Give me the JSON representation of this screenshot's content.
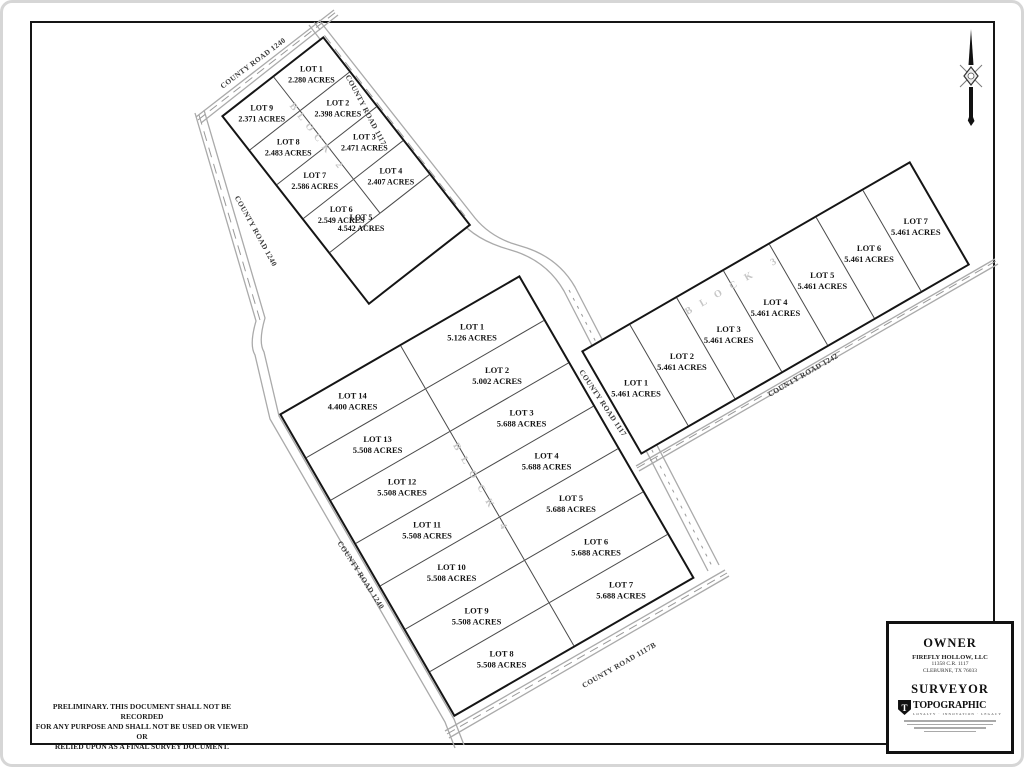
{
  "plat": {
    "preliminary_note_lines": [
      "PRELIMINARY. THIS DOCUMENT SHALL NOT BE RECORDED",
      "FOR ANY PURPOSE AND SHALL NOT BE USED OR VIEWED OR",
      "RELIED UPON AS A FINAL SURVEY DOCUMENT."
    ]
  },
  "roads": {
    "cr1240": "COUNTY ROAD 1240",
    "cr1117": "COUNTY ROAD 1117",
    "cr1117b": "COUNTY ROAD 1117B",
    "cr1242": "COUNTY ROAD 1242"
  },
  "blocks": {
    "block2": {
      "label": "BLOCK 2",
      "left_column": [
        {
          "lot": "LOT 9",
          "acres": "2.371 ACRES"
        },
        {
          "lot": "LOT 8",
          "acres": "2.483 ACRES"
        },
        {
          "lot": "LOT 7",
          "acres": "2.586 ACRES"
        },
        {
          "lot": "LOT 6",
          "acres": "2.549 ACRES"
        }
      ],
      "right_column": [
        {
          "lot": "LOT 1",
          "acres": "2.280 ACRES"
        },
        {
          "lot": "LOT 2",
          "acres": "2.398 ACRES"
        },
        {
          "lot": "LOT 3",
          "acres": "2.471 ACRES"
        },
        {
          "lot": "LOT 4",
          "acres": "2.407 ACRES"
        }
      ],
      "bottom_lot": {
        "lot": "LOT 5",
        "acres": "4.542 ACRES"
      }
    },
    "block4": {
      "label": "BLOCK 4",
      "left_column": [
        {
          "lot": "LOT 14",
          "acres": "4.400 ACRES"
        },
        {
          "lot": "LOT 13",
          "acres": "5.508 ACRES"
        },
        {
          "lot": "LOT 12",
          "acres": "5.508 ACRES"
        },
        {
          "lot": "LOT 11",
          "acres": "5.508 ACRES"
        },
        {
          "lot": "LOT 10",
          "acres": "5.508 ACRES"
        },
        {
          "lot": "LOT 9",
          "acres": "5.508 ACRES"
        },
        {
          "lot": "LOT 8",
          "acres": "5.508 ACRES"
        }
      ],
      "right_column": [
        {
          "lot": "LOT 1",
          "acres": "5.126 ACRES"
        },
        {
          "lot": "LOT 2",
          "acres": "5.002 ACRES"
        },
        {
          "lot": "LOT 3",
          "acres": "5.688 ACRES"
        },
        {
          "lot": "LOT 4",
          "acres": "5.688 ACRES"
        },
        {
          "lot": "LOT 5",
          "acres": "5.688 ACRES"
        },
        {
          "lot": "LOT 6",
          "acres": "5.688 ACRES"
        },
        {
          "lot": "LOT 7",
          "acres": "5.688 ACRES"
        }
      ]
    },
    "block3": {
      "label": "BLOCK 3",
      "lots": [
        {
          "lot": "LOT 1",
          "acres": "5.461 ACRES"
        },
        {
          "lot": "LOT 2",
          "acres": "5.461 ACRES"
        },
        {
          "lot": "LOT 3",
          "acres": "5.461 ACRES"
        },
        {
          "lot": "LOT 4",
          "acres": "5.461 ACRES"
        },
        {
          "lot": "LOT 5",
          "acres": "5.461 ACRES"
        },
        {
          "lot": "LOT 6",
          "acres": "5.461 ACRES"
        },
        {
          "lot": "LOT 7",
          "acres": "5.461 ACRES"
        }
      ]
    }
  },
  "owner": {
    "heading": "OWNER",
    "name": "FIREFLY HOLLOW, LLC",
    "address_line1": "11358 C.R. 1117",
    "address_line2": "CLEBURNE, TX 76033"
  },
  "surveyor": {
    "heading": "SURVEYOR",
    "logo_initial": "T",
    "logo_brand": "TOPOGRAPHIC",
    "logo_tagline": "LOYALTY · INNOVATION · LEGACY"
  }
}
